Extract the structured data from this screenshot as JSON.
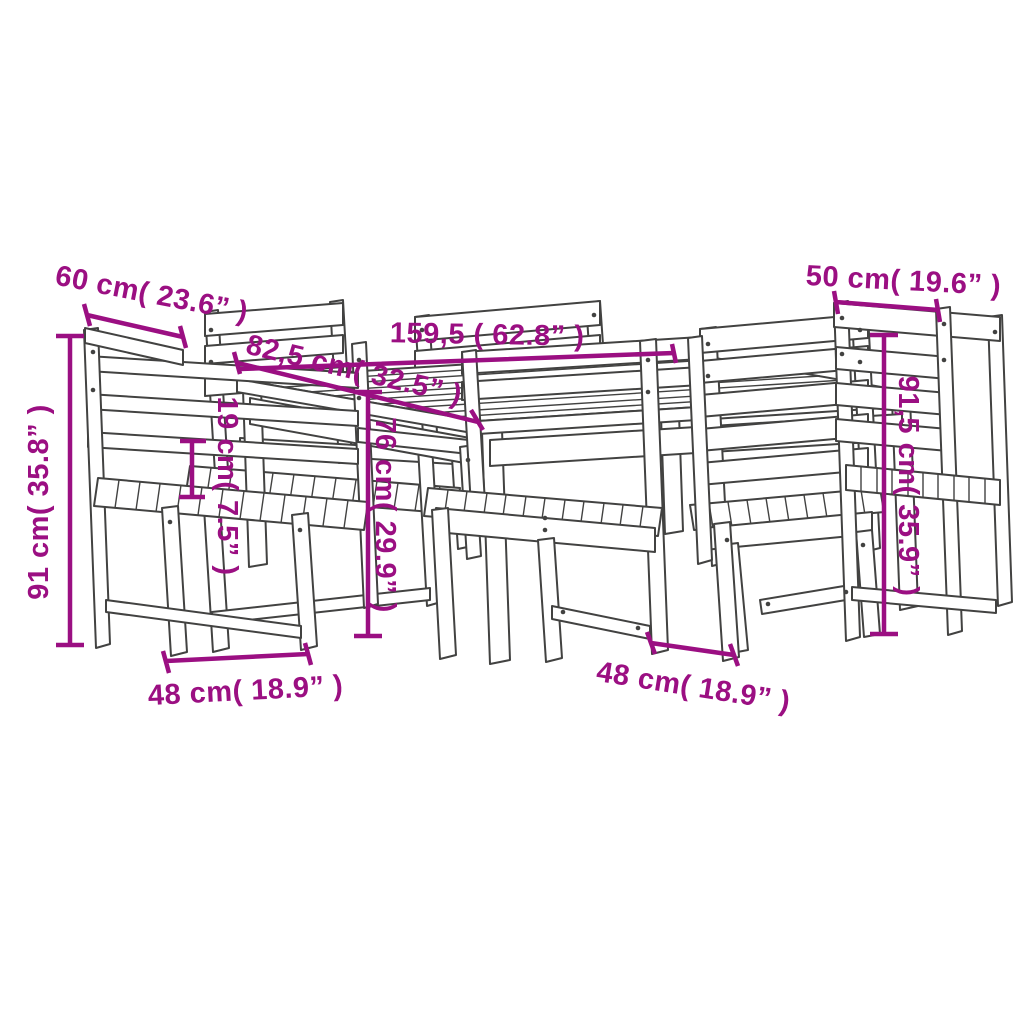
{
  "diagram": {
    "subject": "wooden garden dining set (table with six slatted chairs) technical line drawing",
    "background_color": "#ffffff",
    "line_art_color": "#424241",
    "dimension_color": "#9b0f82"
  },
  "dimensions": [
    {
      "id": "left-chair-top-width",
      "label": "60 cm( 23.6” )"
    },
    {
      "id": "right-chair-top-width",
      "label": "50 cm( 19.6” )"
    },
    {
      "id": "table-depth",
      "label": "82,5 cm( 32.5” )"
    },
    {
      "id": "table-width",
      "label": "159,5 ( 62.8” )"
    },
    {
      "id": "armrest-height",
      "label": "19 cm( 7.5” )"
    },
    {
      "id": "table-height",
      "label": "76 cm( 29.9” )"
    },
    {
      "id": "left-chair-height",
      "label": "91 cm( 35.8” )"
    },
    {
      "id": "right-chair-height",
      "label": "91,5 cm( 35.9” )"
    },
    {
      "id": "front-left-chair-seat-width",
      "label": "48 cm( 18.9” )"
    },
    {
      "id": "front-right-chair-seat-width",
      "label": "48 cm( 18.9” )"
    }
  ]
}
